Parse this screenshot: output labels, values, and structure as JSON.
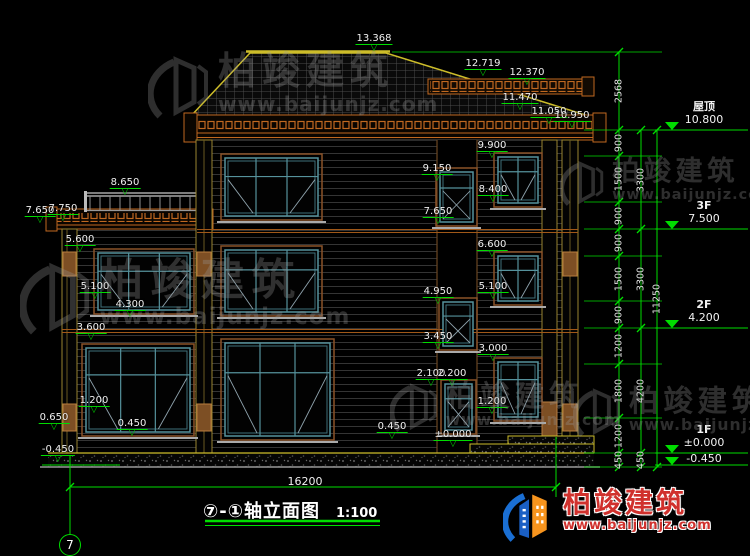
{
  "drawing_title": {
    "text": "⑦-①轴立面图",
    "scale": "1:100"
  },
  "axis_bubble": "7",
  "bottom_dim": {
    "value": "16200"
  },
  "levels": [
    {
      "name": "屋顶",
      "value": "10.800",
      "y": 130
    },
    {
      "name": "3F",
      "value": "7.500",
      "y": 229
    },
    {
      "name": "2F",
      "value": "4.200",
      "y": 328
    },
    {
      "name": "1F",
      "value": "±0.000",
      "y": 453
    },
    {
      "name": "",
      "value": "-0.450",
      "y": 465
    }
  ],
  "elevation_labels": [
    {
      "v": "13.368",
      "x": 374,
      "y": 33
    },
    {
      "v": "12.719",
      "x": 483,
      "y": 58
    },
    {
      "v": "12.370",
      "x": 527,
      "y": 67
    },
    {
      "v": "11.470",
      "x": 520,
      "y": 92
    },
    {
      "v": "11.050",
      "x": 549,
      "y": 106
    },
    {
      "v": "10.950",
      "x": 572,
      "y": 110
    },
    {
      "v": "9.900",
      "x": 492,
      "y": 140
    },
    {
      "v": "9.150",
      "x": 437,
      "y": 163
    },
    {
      "v": "8.400",
      "x": 493,
      "y": 184
    },
    {
      "v": "7.650",
      "x": 438,
      "y": 206
    },
    {
      "v": "6.600",
      "x": 492,
      "y": 239
    },
    {
      "v": "4.950",
      "x": 438,
      "y": 286
    },
    {
      "v": "5.100",
      "x": 493,
      "y": 281
    },
    {
      "v": "3.450",
      "x": 438,
      "y": 331
    },
    {
      "v": "3.000",
      "x": 493,
      "y": 343
    },
    {
      "v": "2.100",
      "x": 431,
      "y": 368
    },
    {
      "v": "2.200",
      "x": 452,
      "y": 368
    },
    {
      "v": "1.200",
      "x": 492,
      "y": 396
    },
    {
      "v": "±0.000",
      "x": 453,
      "y": 429
    },
    {
      "v": "0.450",
      "x": 392,
      "y": 421
    },
    {
      "v": "8.650",
      "x": 125,
      "y": 177
    },
    {
      "v": "7.650",
      "x": 40,
      "y": 205
    },
    {
      "v": "7.750",
      "x": 63,
      "y": 203
    },
    {
      "v": "5.600",
      "x": 80,
      "y": 234
    },
    {
      "v": "5.100",
      "x": 95,
      "y": 281
    },
    {
      "v": "4.300",
      "x": 130,
      "y": 299
    },
    {
      "v": "3.600",
      "x": 91,
      "y": 322
    },
    {
      "v": "1.200",
      "x": 94,
      "y": 395
    },
    {
      "v": "0.650",
      "x": 54,
      "y": 412
    },
    {
      "v": "0.450",
      "x": 132,
      "y": 418
    },
    {
      "v": "-0.450",
      "x": 58,
      "y": 444
    }
  ],
  "dim_chains": [
    {
      "x": 619,
      "segments": [
        [
          "2568",
          52,
          130
        ],
        [
          "900",
          130,
          156
        ],
        [
          "1500",
          156,
          202
        ],
        [
          "900",
          202,
          229
        ],
        [
          "900",
          229,
          256
        ],
        [
          "1500",
          256,
          301
        ],
        [
          "900",
          301,
          328
        ],
        [
          "1200",
          328,
          364
        ],
        [
          "1800",
          364,
          418
        ],
        [
          "1200",
          418,
          453
        ],
        [
          "450",
          453,
          467
        ]
      ]
    },
    {
      "x": 641,
      "segments": [
        [
          "3300",
          130,
          229
        ],
        [
          "3300",
          229,
          328
        ],
        [
          "4200",
          328,
          453
        ],
        [
          "450",
          453,
          467
        ]
      ]
    },
    {
      "x": 657,
      "segments": [
        [
          "11250",
          130,
          467
        ]
      ]
    }
  ],
  "watermark_text": {
    "brand": "柏竣建筑",
    "url": "www.baijunjz.com"
  },
  "watermark_positions": [
    {
      "x": 148,
      "y": 52,
      "s": 1.0
    },
    {
      "x": 560,
      "y": 158,
      "s": 0.72
    },
    {
      "x": 20,
      "y": 258,
      "s": 1.15
    },
    {
      "x": 390,
      "y": 380,
      "s": 0.78
    },
    {
      "x": 573,
      "y": 385,
      "s": 0.78
    }
  ],
  "logo": {
    "brand": "柏竣建筑",
    "url": "www.baijunjz.com"
  }
}
